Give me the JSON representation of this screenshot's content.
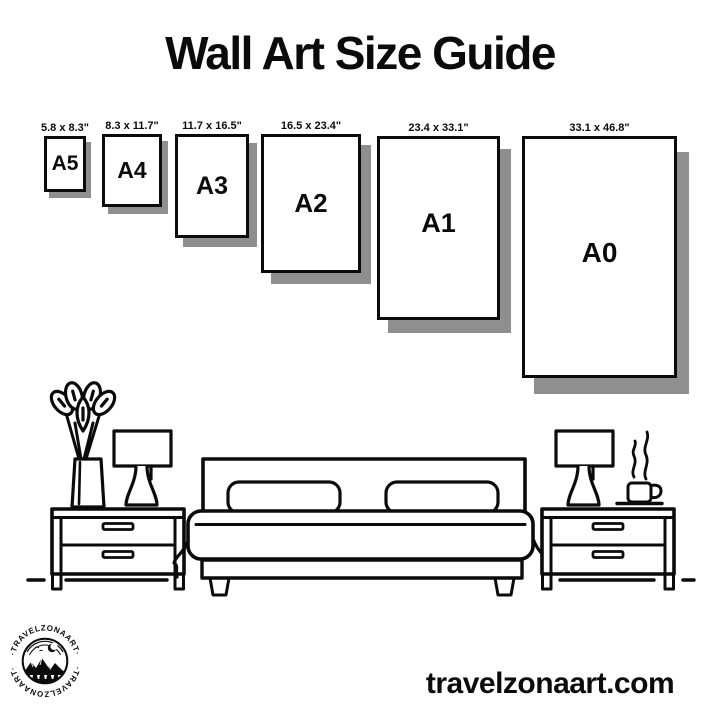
{
  "title": "Wall Art Size Guide",
  "sizes": [
    {
      "name": "A5",
      "dimensions": "5.8 x 8.3\""
    },
    {
      "name": "A4",
      "dimensions": "8.3 x 11.7\""
    },
    {
      "name": "A3",
      "dimensions": "11.7 x 16.5\""
    },
    {
      "name": "A2",
      "dimensions": "16.5 x 23.4\""
    },
    {
      "name": "A1",
      "dimensions": "23.4 x 33.1\""
    },
    {
      "name": "A0",
      "dimensions": "33.1 x 46.8\""
    }
  ],
  "illustration": {
    "icons": [
      "plant-icon",
      "lamp-icon",
      "nightstand",
      "bed-icon",
      "pillow",
      "coffee-cup-icon",
      "steam-icon",
      "floor-line"
    ]
  },
  "logo": {
    "arc_text_top": "·TRAVELZONAART·",
    "arc_text_bottom": "·TRAVELZONAART·"
  },
  "website": "travelzonaart.com",
  "colors": {
    "ink": "#0b0b0b",
    "shadow": "#8f8f8f",
    "background": "#ffffff"
  }
}
